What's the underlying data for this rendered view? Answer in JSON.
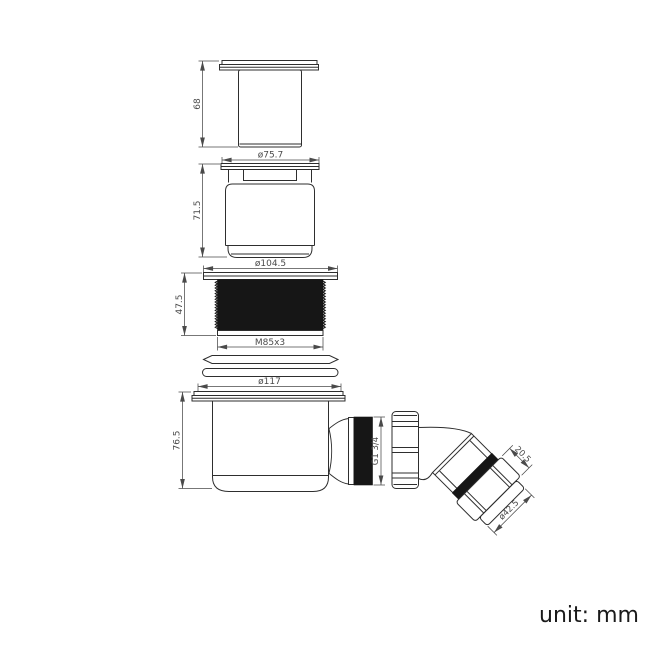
{
  "drawing": {
    "dimensions": {
      "cap_height": "68",
      "insert_flange_diameter": "ø75.7",
      "insert_height": "71.5",
      "locknut_flange_diameter": "ø104.5",
      "locknut_height": "47.5",
      "locknut_thread": "M85x3",
      "body_flange_diameter": "ø117",
      "body_height": "76.5",
      "outlet_thread": "G1 3/4",
      "elbow_nut_length": "20.5",
      "elbow_outlet_diameter": "ø42.5"
    },
    "colors": {
      "outline": "#2e2e2e",
      "dimension": "#4a4a4a",
      "thread_fill": "#161616",
      "background": "#ffffff"
    }
  },
  "footer": {
    "unit_label": "unit: mm"
  }
}
